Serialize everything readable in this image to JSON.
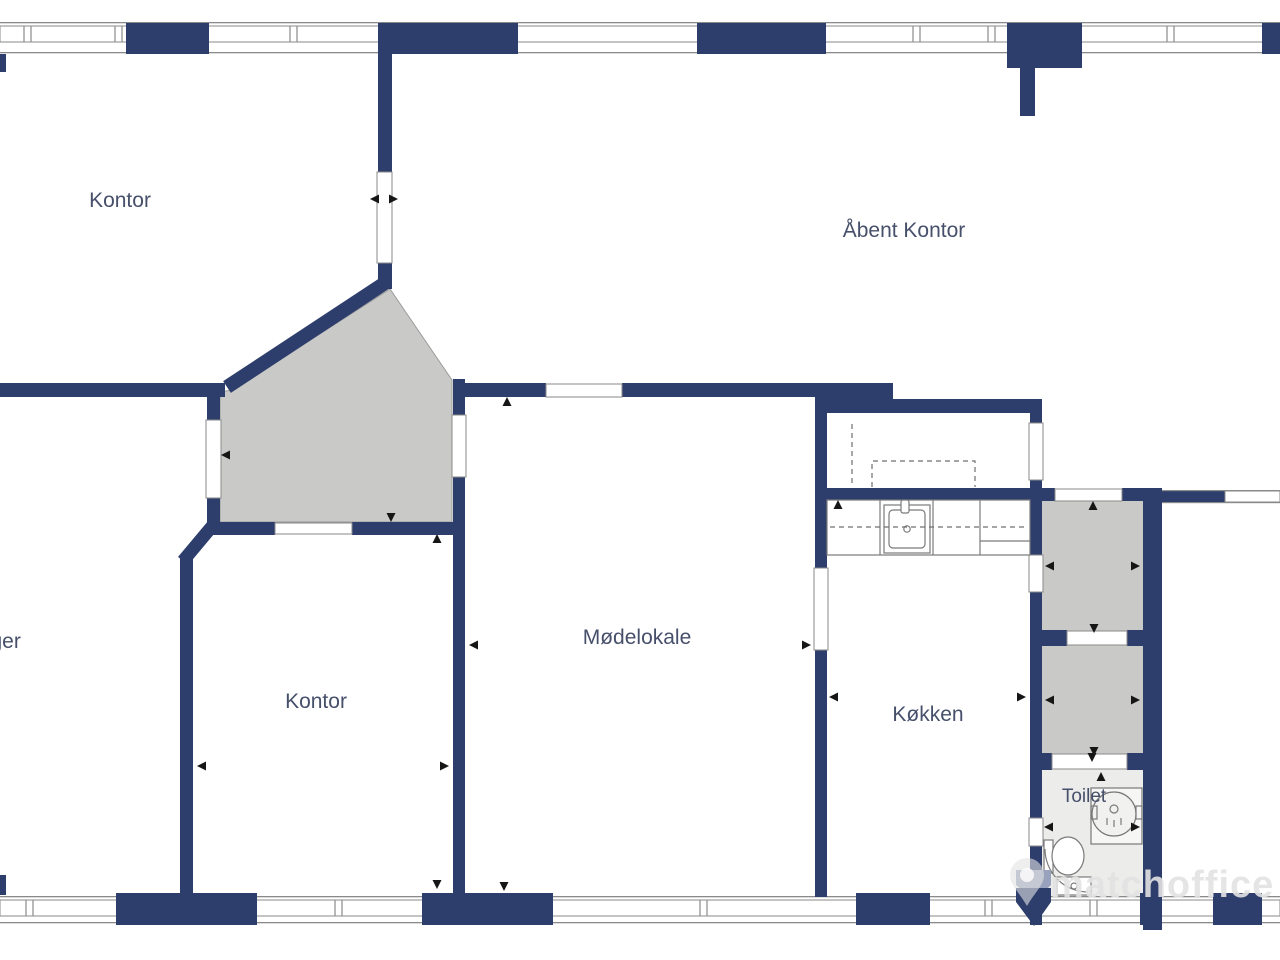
{
  "colors": {
    "wall": "#2e3e6c",
    "line": "#8a8a8a",
    "hall-floor": "#c9c9c8",
    "toilet-floor": "#ececeb",
    "label": "#47506b",
    "watermark": "#e3e3e3",
    "arrow": "#161616"
  },
  "rooms": [
    {
      "id": "kontor-1",
      "label": "Kontor"
    },
    {
      "id": "aabent-kontor",
      "label": "Åbent Kontor"
    },
    {
      "id": "lager",
      "label": "Lager"
    },
    {
      "id": "kontor-2",
      "label": "Kontor"
    },
    {
      "id": "moedelokale",
      "label": "Mødelokale"
    },
    {
      "id": "koekken",
      "label": "Køkken"
    },
    {
      "id": "toilet",
      "label": "Toilet"
    }
  ],
  "watermark": {
    "text": "matchoffice"
  }
}
